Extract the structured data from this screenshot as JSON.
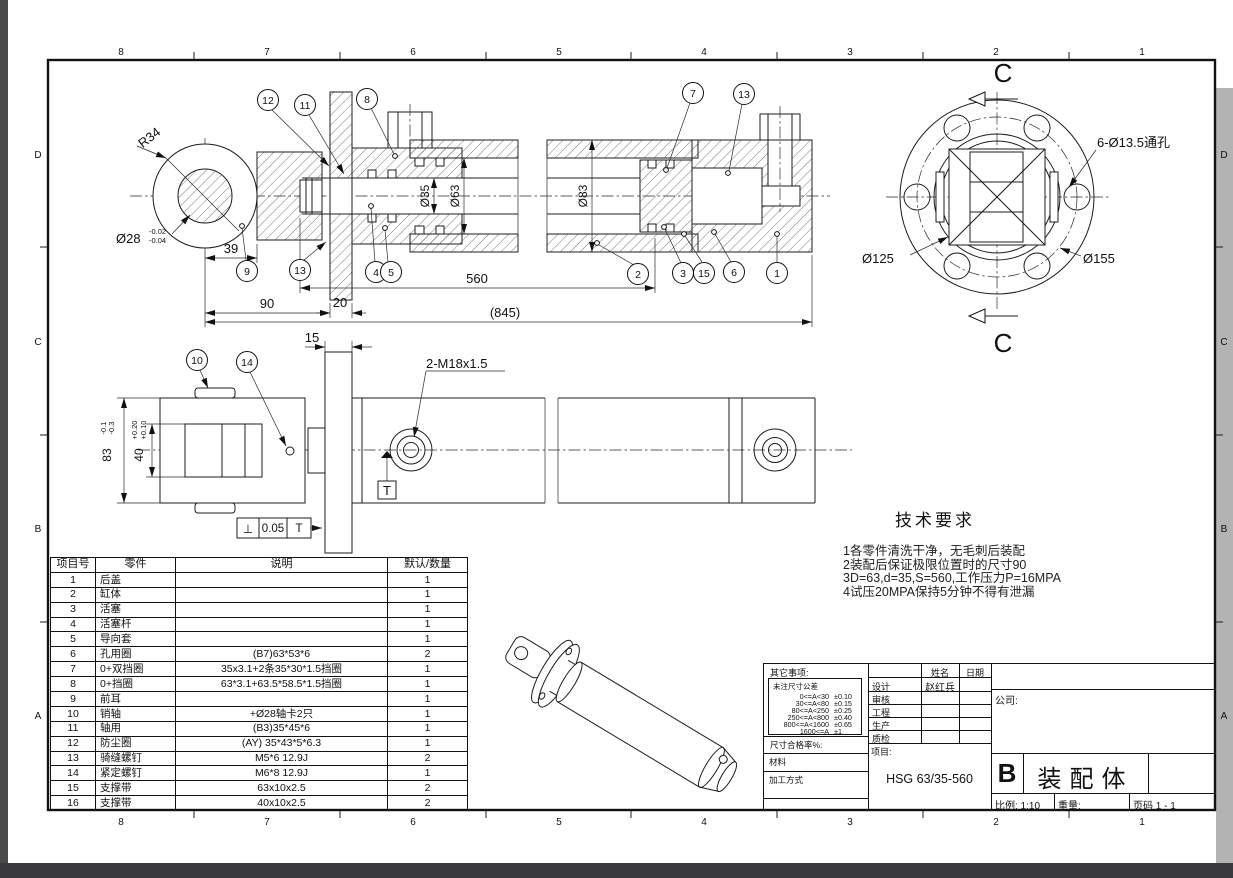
{
  "frame": {
    "cols": [
      "8",
      "7",
      "6",
      "5",
      "4",
      "3",
      "2",
      "1"
    ],
    "rows": [
      "D",
      "C",
      "B",
      "A"
    ]
  },
  "top_view": {
    "dims": {
      "r34": "R34",
      "d28": "Ø28",
      "d28_up": "-0.02",
      "d28_lo": "-0.04",
      "d35": "Ø35",
      "d63": "Ø63",
      "d83": "Ø83",
      "l39": "39",
      "l90": "90",
      "l20": "20",
      "l560": "560",
      "l845": "(845)"
    },
    "balloons": {
      "b12": "12",
      "b11": "11",
      "b8": "8",
      "b7": "7",
      "b13a": "13",
      "b9": "9",
      "b13b": "13",
      "b4": "4",
      "b5": "5",
      "b2": "2",
      "b3": "3",
      "b15": "15",
      "b6": "6",
      "b1": "1"
    }
  },
  "section_view": {
    "mark": "C",
    "holes_label": "6-Ø13.5通孔",
    "d125": "Ø125",
    "d155": "Ø155"
  },
  "lower_view": {
    "dims": {
      "l15": "15",
      "thread": "2-M18x1.5",
      "h83": "83",
      "h83_up": "-0.1",
      "h83_lo": "-0.3",
      "w40": "40",
      "w40_up": "+0.20",
      "w40_lo": "+0.10"
    },
    "balloons": {
      "b10": "10",
      "b14": "14"
    },
    "datum": "T",
    "gdt_sym": "⊥",
    "gdt_val": "0.05",
    "gdt_ref": "T"
  },
  "tech_req": {
    "title": "技术要求",
    "line1": "1各零件清洗干净，无毛刺后装配",
    "line2": "2装配后保证极限位置时的尺寸90",
    "line3": "3D=63,d=35,S=560,工作压力P=16MPA",
    "line4": "4试压20MPA保持5分钟不得有泄漏"
  },
  "parts_table": {
    "h1": "项目号",
    "h2": "零件",
    "h3": "说明",
    "h4": "默认/数量",
    "rows": [
      [
        "1",
        "后盖",
        "",
        "1"
      ],
      [
        "2",
        "缸体",
        "",
        "1"
      ],
      [
        "3",
        "活塞",
        "",
        "1"
      ],
      [
        "4",
        "活塞杆",
        "",
        "1"
      ],
      [
        "5",
        "导向套",
        "",
        "1"
      ],
      [
        "6",
        "孔用圈",
        "(B7)63*53*6",
        "2"
      ],
      [
        "7",
        "0+双挡圈",
        "35x3.1+2条35*30*1.5挡圈",
        "1"
      ],
      [
        "8",
        "0+挡圈",
        "63*3.1+63.5*58.5*1.5挡圈",
        "1"
      ],
      [
        "9",
        "前耳",
        "",
        "1"
      ],
      [
        "10",
        "销轴",
        "+Ø28轴卡2只",
        "1"
      ],
      [
        "11",
        "轴用",
        "(B3)35*45*6",
        "1"
      ],
      [
        "12",
        "防尘圈",
        "(AY) 35*43*5*6.3",
        "1"
      ],
      [
        "13",
        "骑缝螺钉",
        "M5*6  12.9J",
        "2"
      ],
      [
        "14",
        "紧定螺钉",
        "M6*8  12.9J",
        "1"
      ],
      [
        "15",
        "支撑带",
        "63x10x2.5",
        "2"
      ],
      [
        "16",
        "支撑带",
        "40x10x2.5",
        "2"
      ]
    ]
  },
  "title_block": {
    "other": "其它事项:",
    "tol_title": "未注尺寸公差",
    "tol": [
      [
        "0<=A<30",
        "±0.10"
      ],
      [
        "30<=A<80",
        "±0.15"
      ],
      [
        "80<=A<250",
        "±0.25"
      ],
      [
        "250<=A<800",
        "±0.40"
      ],
      [
        "800<=A<1600",
        "±0.65"
      ],
      [
        "1600<=A",
        "±1"
      ]
    ],
    "rate": "尺寸合格率%:",
    "material": "材料",
    "process": "加工方式",
    "name_h": "姓名",
    "date_h": "日期",
    "r1": "设计",
    "r1n": "赵红兵",
    "r2": "审核",
    "r3": "工程",
    "r4": "生产",
    "r5": "质检",
    "project": "项目:",
    "project_no": "HSG 63/35-560",
    "company": "公司:",
    "rev": "B",
    "title": "装配体",
    "scale": "比例: 1:10",
    "weight": "重量:",
    "page": "页码 1 - 1"
  }
}
